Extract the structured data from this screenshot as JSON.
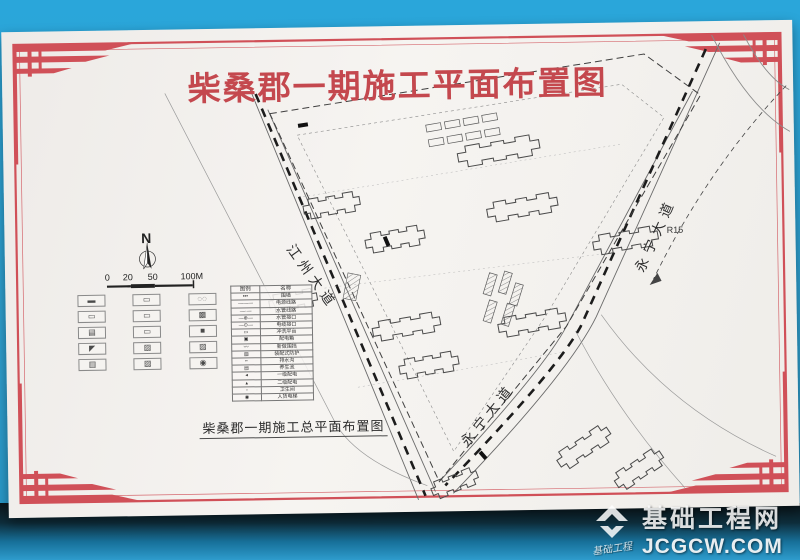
{
  "colors": {
    "photo_background": "#2aa6da",
    "board": "#f4f2ef",
    "frame_red": "#cf4e55",
    "title_red": "#c4484e",
    "drawing_line": "#4a4a4a",
    "watermark_white": "#ffffff"
  },
  "title": "柴桑郡一期施工平面布置图",
  "caption": "柴桑郡一期施工总平面布置图",
  "plan": {
    "road_labels": {
      "left": "江州大道",
      "right_top": "永宁大道",
      "right_bottom": "永宁大道"
    },
    "north_label": "N",
    "annotation_radius": "R15",
    "scale_bar": {
      "ticks": [
        "0",
        "20",
        "50",
        "100M"
      ]
    }
  },
  "legend": {
    "header": {
      "symbol": "图例",
      "name": "名称"
    },
    "rows": [
      {
        "glyph": "▪▪▪",
        "name": "围墙"
      },
      {
        "glyph": "———",
        "name": "电源线路"
      },
      {
        "glyph": "—·—",
        "name": "水管线路"
      },
      {
        "glyph": "—⊕—",
        "name": "水管接口"
      },
      {
        "glyph": "—⊙—",
        "name": "电缆接口"
      },
      {
        "glyph": "▭",
        "name": "冲洗平台"
      },
      {
        "glyph": "▣",
        "name": "配电箱"
      },
      {
        "glyph": "〰",
        "name": "新做围挡"
      },
      {
        "glyph": "▨",
        "name": "装配式防护"
      },
      {
        "glyph": "┉",
        "name": "排水沟"
      },
      {
        "glyph": "▤",
        "name": "养生池"
      },
      {
        "glyph": "◂",
        "name": "一级配电"
      },
      {
        "glyph": "▴",
        "name": "二级配电"
      },
      {
        "glyph": "▫",
        "name": "卫生间"
      },
      {
        "glyph": "◉",
        "name": "人货电梯"
      }
    ],
    "symbol_grid": [
      {
        "glyph": "▬",
        "name": "fence-dash-symbol"
      },
      {
        "glyph": "▭",
        "name": "rect-outline-symbol"
      },
      {
        "glyph": "◌◌",
        "name": "machine-symbol"
      },
      {
        "glyph": "▭",
        "name": "rect-outline-symbol"
      },
      {
        "glyph": "▭",
        "name": "rect-outline-symbol"
      },
      {
        "glyph": "▩",
        "name": "checker-rect-symbol"
      },
      {
        "glyph": "▤",
        "name": "striped-rect-symbol"
      },
      {
        "glyph": "▭",
        "name": "rect-outline-symbol"
      },
      {
        "glyph": "■",
        "name": "solid-rect-symbol"
      },
      {
        "glyph": "◤",
        "name": "flag-symbol"
      },
      {
        "glyph": "▨",
        "name": "diagonal-hatch-symbol"
      },
      {
        "glyph": "▨",
        "name": "diagonal-hatch-symbol"
      },
      {
        "glyph": "▥",
        "name": "vertical-hatch-symbol"
      },
      {
        "glyph": "▨",
        "name": "diagonal-hatch-symbol"
      },
      {
        "glyph": "◉",
        "name": "circle-dot-symbol"
      }
    ]
  },
  "watermark": {
    "site_name": "基础工程网",
    "site_url": "JCGCW.COM",
    "logo_caption": "基础工程"
  }
}
